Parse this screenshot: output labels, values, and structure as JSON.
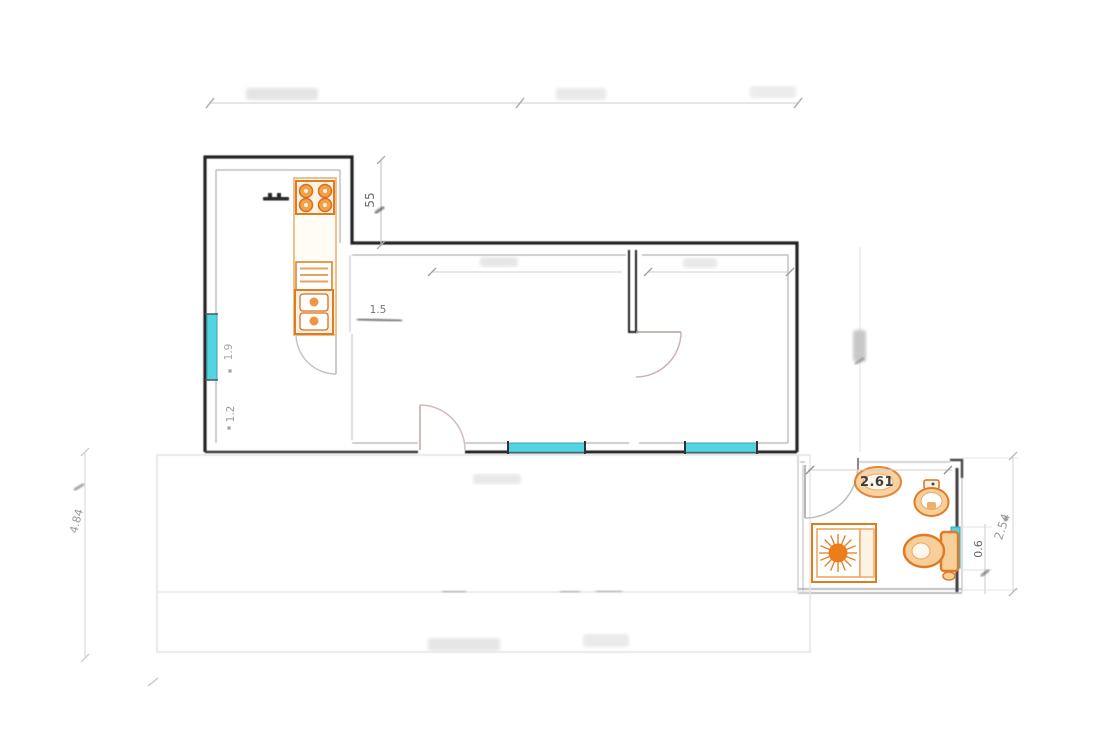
{
  "drawing": {
    "type": "apartment floor plan",
    "dimension_labels": {
      "top_wall_height": "55",
      "kitchen_passage": "1.5",
      "kitchen_window_upper": "1.9",
      "kitchen_window_lower": "1.2",
      "left_side_height": "4.84",
      "bathroom_width": "2.61",
      "bathroom_window_width": "0.6",
      "bathroom_side_height": "2.54"
    },
    "fixtures": {
      "kitchen": [
        "stove-4-burner",
        "counter",
        "dishwasher",
        "double-sink"
      ],
      "bathroom": [
        "shower-tray",
        "washbasin",
        "bidet",
        "toilet"
      ]
    },
    "window_count": 4,
    "colors": {
      "wall": "#202020",
      "fixture_orange": "#e07b23",
      "fixture_fill": "#f7cf9b",
      "window_cyan": "#52d5e0",
      "window_border": "#2fa8b8",
      "dimension_text": "#8f8f8f",
      "faded_line": "#dcdcdc"
    }
  }
}
